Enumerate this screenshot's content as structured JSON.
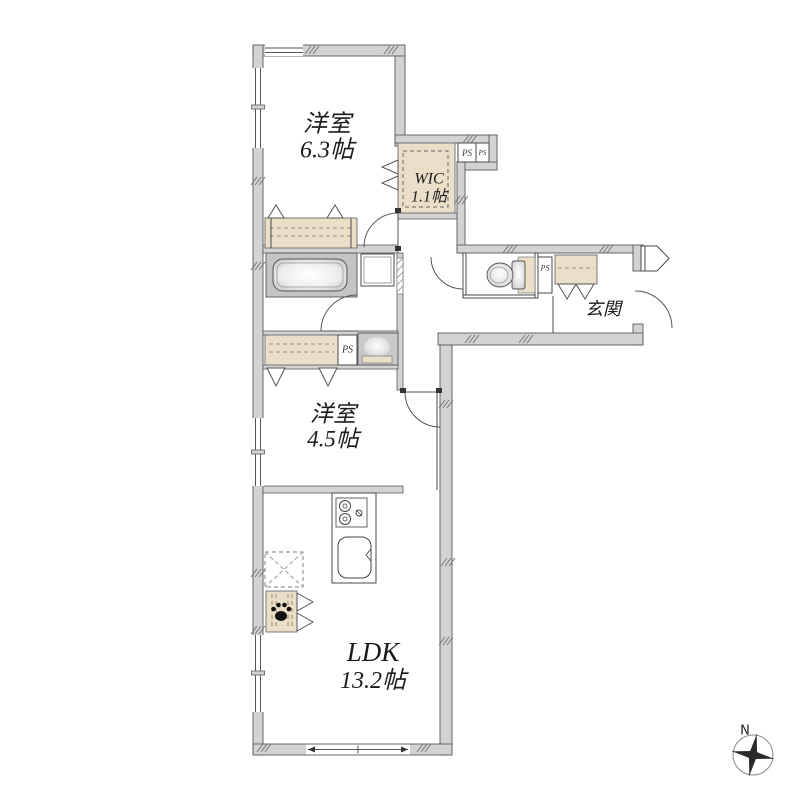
{
  "rooms": {
    "bedroom_top": {
      "name": "洋室",
      "size": "6.3帖"
    },
    "wic": {
      "name": "WIC",
      "size": "1.1帖"
    },
    "entrance": {
      "name": "玄関"
    },
    "bedroom_mid": {
      "name": "洋室",
      "size": "4.5帖"
    },
    "ldk": {
      "name": "LDK",
      "size": "13.2帖"
    }
  },
  "ps_labels": {
    "wic_1": "PS",
    "wic_2": "PS",
    "toilet": "PS",
    "washroom": "PS"
  },
  "compass": {
    "north": "N"
  },
  "colors": {
    "wall_fill": "#d3d3d3",
    "closet_fill": "#ecdfc8",
    "bath_fill": "#c4c4c4",
    "outline": "#4a4a4a"
  }
}
